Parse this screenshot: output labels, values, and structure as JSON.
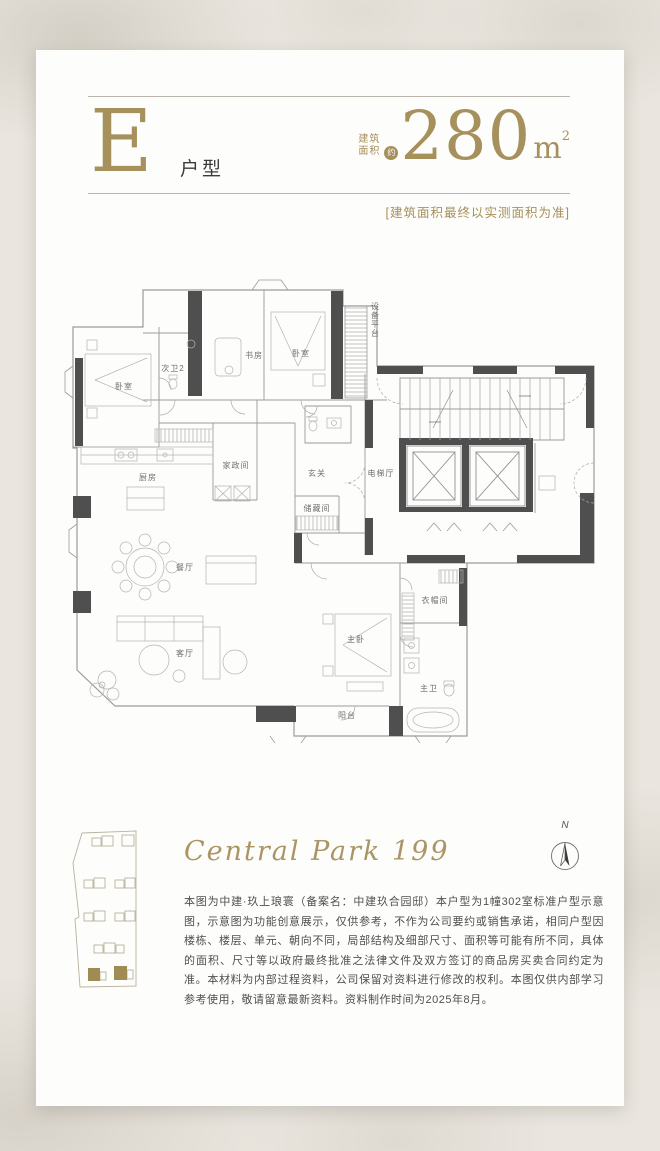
{
  "page": {
    "background": "#eae6df",
    "card": "#fdfdfb",
    "accent_gold": "#a6905c"
  },
  "header": {
    "unit_letter": "E",
    "unit_type_label": "户型",
    "area_label_line1": "建筑",
    "area_label_line2": "面积",
    "area_approx": "约",
    "area_value": "280",
    "area_unit": "m",
    "area_unit_exponent": "2",
    "area_disclaimer": "[建筑面积最终以实测面积为准]"
  },
  "floorplan": {
    "compass_label": "N",
    "rooms": [
      {
        "id": "bedroom-left",
        "label": "卧室"
      },
      {
        "id": "second-bath-2",
        "label": "次卫2"
      },
      {
        "id": "study",
        "label": "书房"
      },
      {
        "id": "bedroom-2",
        "label": "卧室"
      },
      {
        "id": "equipment-platform",
        "label": "设备平台"
      },
      {
        "id": "kitchen",
        "label": "厨房"
      },
      {
        "id": "housekeeping-room",
        "label": "家政间"
      },
      {
        "id": "foyer",
        "label": "玄关"
      },
      {
        "id": "elevator-hall",
        "label": "电梯厅"
      },
      {
        "id": "storage-room",
        "label": "储藏间"
      },
      {
        "id": "dining-room",
        "label": "餐厅"
      },
      {
        "id": "living-room",
        "label": "客厅"
      },
      {
        "id": "master-bedroom",
        "label": "主卧"
      },
      {
        "id": "walk-in-closet",
        "label": "衣帽间"
      },
      {
        "id": "master-bath",
        "label": "主卫"
      },
      {
        "id": "balcony",
        "label": "阳台"
      }
    ]
  },
  "footer": {
    "project_script_name": "Central Park 199",
    "disclaimer": "本图为中建·玖上琅寰（备案名：中建玖合园邸）本户型为1幢302室标准户型示意图，示意图为功能创意展示，仅供参考，不作为公司要约或销售承诺，相同户型因楼栋、楼层、单元、朝向不同，局部结构及细部尺寸、面积等可能有所不同，具体的面积、尺寸等以政府最终批准之法律文件及双方签订的商品房买卖合同约定为准。本材料为内部过程资料，公司保留对资料进行修改的权利。本图仅供内部学习参考使用，敬请留意最新资料。资料制作时间为2025年8月。"
  }
}
